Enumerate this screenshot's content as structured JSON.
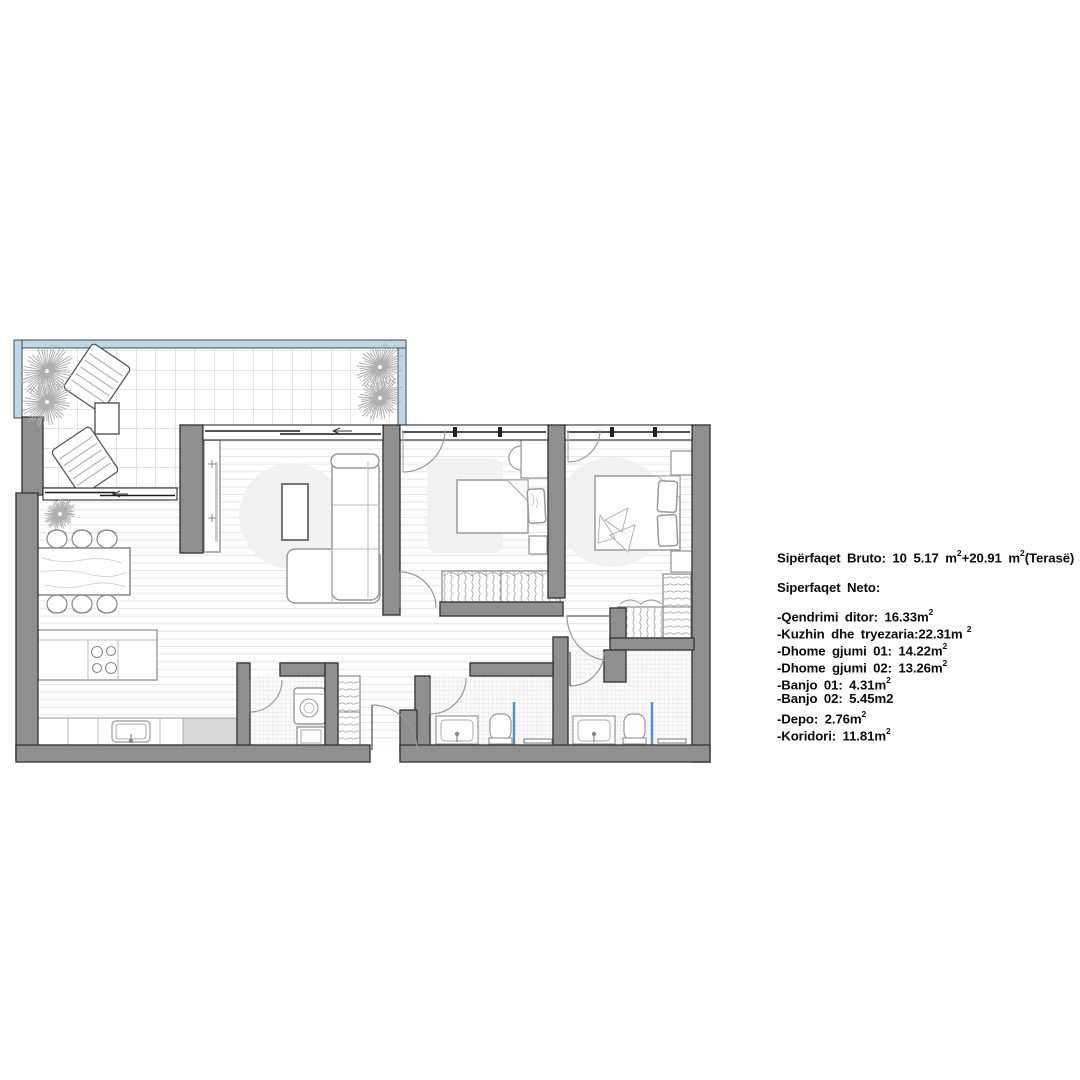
{
  "colors": {
    "wall_fill": "#8f8f8f",
    "wall_outline": "#3a3a3a",
    "terrace_rail_blue": "#bcd7ea",
    "shower_blue": "#4a90d9",
    "floor_line": "#e6e6e6",
    "tile_line": "#c9c9c9",
    "bath_tile_line": "#dedede",
    "rug_fill": "#f2f2f2",
    "counter_gray": "#d7d7d7",
    "furniture_stroke": "#999999",
    "text_color": "#0a0a0a"
  },
  "annotation": {
    "lines": [
      {
        "name": "gross-area",
        "segments": [
          {
            "t": "Sipërfaqet Bruto: 10 5.17 m"
          },
          {
            "t": "2",
            "sup": true
          },
          {
            "t": "+20.91 m"
          },
          {
            "t": "2",
            "sup": true
          },
          {
            "t": "(Terasë)"
          }
        ]
      },
      {
        "name": "net-heading",
        "segments": [
          {
            "t": "Siperfaqet Neto:"
          }
        ]
      },
      {
        "name": "room-qendrimi",
        "segments": [
          {
            "t": "-Qendrimi ditor: 16.33m"
          },
          {
            "t": "2",
            "sup": true
          }
        ]
      },
      {
        "name": "room-kuzhin",
        "segments": [
          {
            "t": "-Kuzhin dhe tryezaria:22.31m"
          },
          {
            "t": " 2",
            "sup": true
          }
        ]
      },
      {
        "name": "room-dhome-01",
        "segments": [
          {
            "t": "-Dhome gjumi 01: 14.22m"
          },
          {
            "t": "2",
            "sup": true
          }
        ]
      },
      {
        "name": "room-dhome-02",
        "segments": [
          {
            "t": "-Dhome gjumi 02: 13.26m"
          },
          {
            "t": "2",
            "sup": true
          }
        ]
      },
      {
        "name": "room-banjo-01",
        "segments": [
          {
            "t": "-Banjo 01: 4.31m"
          },
          {
            "t": "2",
            "sup": true
          }
        ]
      },
      {
        "name": "room-banjo-02",
        "segments": [
          {
            "t": "-Banjo 02: 5.45m2"
          }
        ]
      },
      {
        "name": "room-depo",
        "segments": [
          {
            "t": "-Depo: 2.76m"
          },
          {
            "t": "2",
            "sup": true
          }
        ]
      },
      {
        "name": "room-koridori",
        "segments": [
          {
            "t": "-Koridori: 11.81m"
          },
          {
            "t": "2",
            "sup": true
          }
        ]
      }
    ]
  }
}
